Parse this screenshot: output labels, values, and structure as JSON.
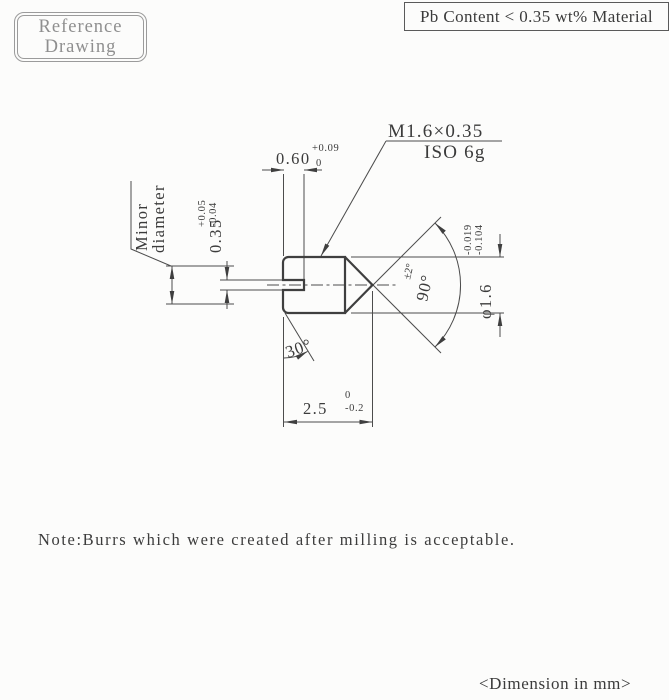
{
  "stamp": {
    "line1": "Reference",
    "line2": "Drawing"
  },
  "material_note": "Pb Content < 0.35 wt% Material",
  "thread": {
    "callout": "M1.6×0.35",
    "fit": "ISO 6g"
  },
  "dims": {
    "slot_depth": {
      "value": "0.60",
      "upper": "+0.09",
      "lower": "0"
    },
    "slot_width": {
      "value": "0.35",
      "upper": "+0.05",
      "lower": "-0.04"
    },
    "minor_dia_label": {
      "line1": "Minor",
      "line2": "diameter"
    },
    "major_dia": {
      "value": "φ1.6",
      "upper": "-0.019",
      "lower": "-0.104"
    },
    "cone_angle": {
      "value": "90°",
      "tol": "±2°"
    },
    "chamfer_angle": "30°",
    "length": {
      "value": "2.5",
      "upper": "0",
      "lower": "-0.2"
    }
  },
  "note": "Note:Burrs which were created after milling is acceptable.",
  "units_note": "<Dimension in mm>",
  "colors": {
    "outline": "#3f3f3f",
    "thin_line": "#4c4c4c",
    "stamp_gray": "#9b9b9b"
  }
}
